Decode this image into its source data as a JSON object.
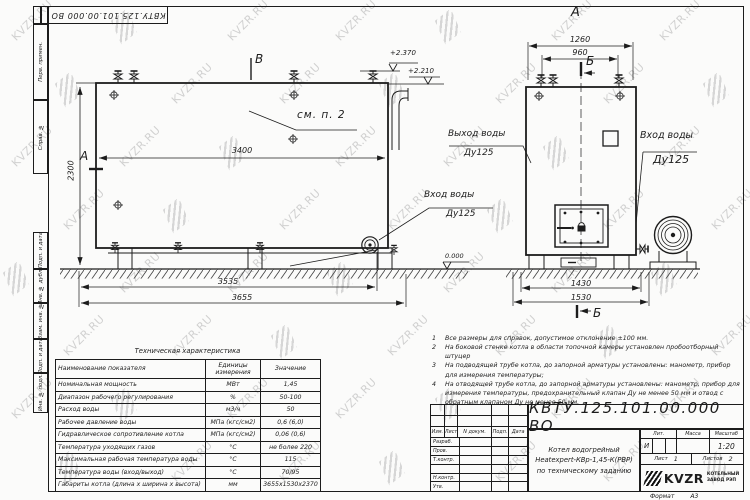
{
  "watermark": {
    "text": "KVZR.RU"
  },
  "top_stamp": {
    "code": "КВТУ.125.101.00.000  ВО"
  },
  "margin": {
    "cells": [
      "Перв. примен.",
      "Справ. №",
      "Подп. и дата",
      "Инв. № дубл.",
      "Взам. инв. №",
      "Подп. и дата",
      "Инв. № подл."
    ]
  },
  "left_view": {
    "section_top": "В",
    "section_side": "А",
    "see_note": "см. п. 2",
    "dim_width": "3400",
    "dim_height": "2300",
    "dim_base": "3535",
    "dim_total": "3655",
    "elev_top": "+2.370",
    "elev_step": "+2.210",
    "elev_ground": "0.000",
    "inlet_title": "Вход воды",
    "inlet_dn": "Ду125",
    "outlet_title": "Выход воды",
    "outlet_dn": "Ду125"
  },
  "right_view": {
    "view_label": "А",
    "section_top": "Б",
    "section_bottom": "Б",
    "dim_top_outer": "1260",
    "dim_top_inner": "960",
    "dim_base_inner": "1430",
    "dim_base_outer": "1530",
    "inlet_title": "Вход воды",
    "inlet_dn": "Ду125"
  },
  "spec_table": {
    "title": "Техническая характеристика",
    "col_name": "Наименование показателя",
    "col_units": "Единицы измерения",
    "col_value": "Значение",
    "rows": [
      {
        "name": "Номинальная мощность",
        "units": "МВт",
        "value": "1,45"
      },
      {
        "name": "Диапазон рабочего регулирования",
        "units": "%",
        "value": "50-100"
      },
      {
        "name": "Расход воды",
        "units": "м3/ч",
        "value": "50"
      },
      {
        "name": "Рабочее давление воды",
        "units": "МПа (кгс/см2)",
        "value": "0,6 (6,0)"
      },
      {
        "name": "Гидравлическое сопротивление котла",
        "units": "МПа (кгс/см2)",
        "value": "0,06 (0,6)"
      },
      {
        "name": "Температура уходящих газов",
        "units": "°С",
        "value": "не более 220"
      },
      {
        "name": "Максимальная рабочая температура воды",
        "units": "°С",
        "value": "115"
      },
      {
        "name": "Температура воды (вход/выход)",
        "units": "°С",
        "value": "70/95"
      },
      {
        "name": "Габариты котла (длина х ширина х высота)",
        "units": "мм",
        "value": "3655х1530х2370"
      }
    ]
  },
  "notes": [
    {
      "num": "1",
      "text": "Все размеры для справок, допустимое отклонение ±100 мм."
    },
    {
      "num": "2",
      "text": "На боковой стенке котла в области топочной камеры установлен пробоотборный штуцер"
    },
    {
      "num": "3",
      "text": "На подводящей трубе котла, до запорной арматуры установлены: манометр, прибор для измерения температуры;"
    },
    {
      "num": "4",
      "text": "На отводящей трубе котла, до запорной арматуры установлены: манометр, прибор для измерения температуры, предохранительный клапан Ду не менее 50 мм и отвод с обратным клапаном Ду не менее 50 мм."
    }
  ],
  "title_block": {
    "doc_number": "КВТУ.125.101.00.000  ВО",
    "name_line1": "Котел водогрейный",
    "name_line2": "Heatexpert-КВр-1,45-К(РВР)",
    "name_line3": "по техническому заданию",
    "col_izm": "Изм.",
    "col_list": "Лист",
    "col_doc": "N докум.",
    "col_sign": "Подп.",
    "col_date": "Дата",
    "roles": [
      "Разраб.",
      "Пров.",
      "Т.контр.",
      "",
      "Н.контр.",
      "Утв."
    ],
    "lit_label": "Лит.",
    "mass_label": "Масса",
    "scale_label": "Масштаб",
    "lit_value": "И",
    "scale_value": "1:20",
    "sheet_label": "Лист",
    "sheet_value": "1",
    "sheets_label": "Листов",
    "sheets_value": "2",
    "logo_text": "KVZR",
    "company_line1": "КОТЕЛЬНЫЙ",
    "company_line2": "ЗАВОД РЭП",
    "format_label": "Формат",
    "format_value": "А3"
  }
}
